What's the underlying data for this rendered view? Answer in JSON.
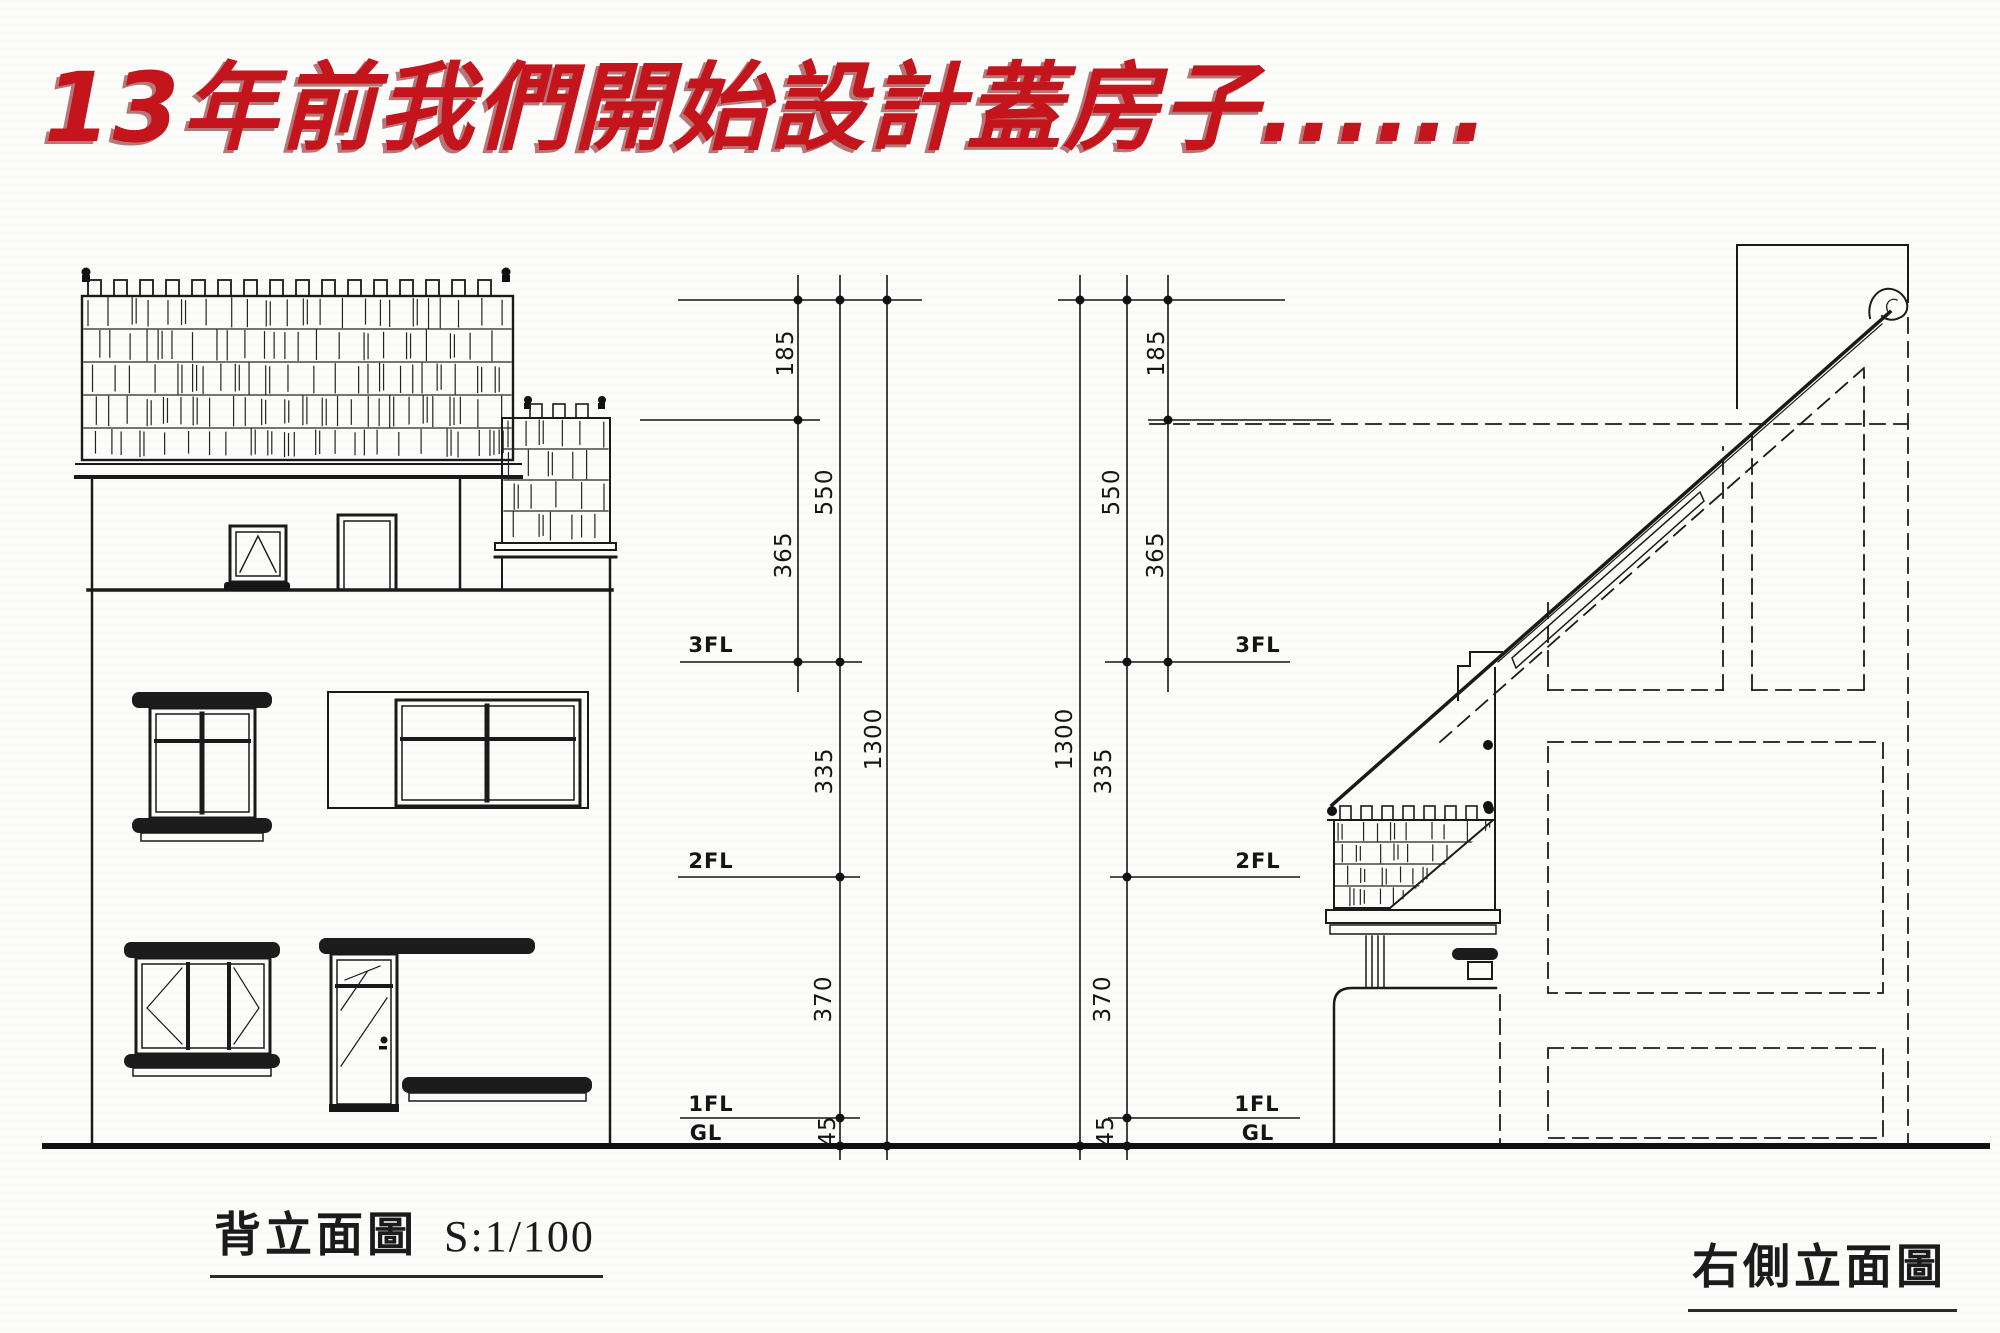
{
  "title": {
    "text": "13年前我們開始設計蓋房子......",
    "color": "#c3151b"
  },
  "captions": {
    "back": {
      "name": "背立面圖",
      "scale": "S:1/100"
    },
    "right": {
      "name": "右側立面圖"
    }
  },
  "dims": {
    "v185": "185",
    "v550": "550",
    "v365": "365",
    "v1300": "1300",
    "v335": "335",
    "v370": "370",
    "v45": "45"
  },
  "floors": {
    "f3": "3FL",
    "f2": "2FL",
    "f1": "1FL",
    "gl": "GL"
  },
  "drawing": {
    "type": "architectural-elevation",
    "views": [
      "back-elevation",
      "right-side-elevation"
    ],
    "scale": "1/100",
    "levels_cm": {
      "ridge_to_eave": 185,
      "eave_to_3FL": 365,
      "ridge_to_3FL": 550,
      "3FL_to_2FL": 335,
      "2FL_to_1FL": 370,
      "1FL_to_GL": 45,
      "total": 1300
    },
    "line_color": "#1a1a1a",
    "paper_color": "#fcfcfb"
  }
}
